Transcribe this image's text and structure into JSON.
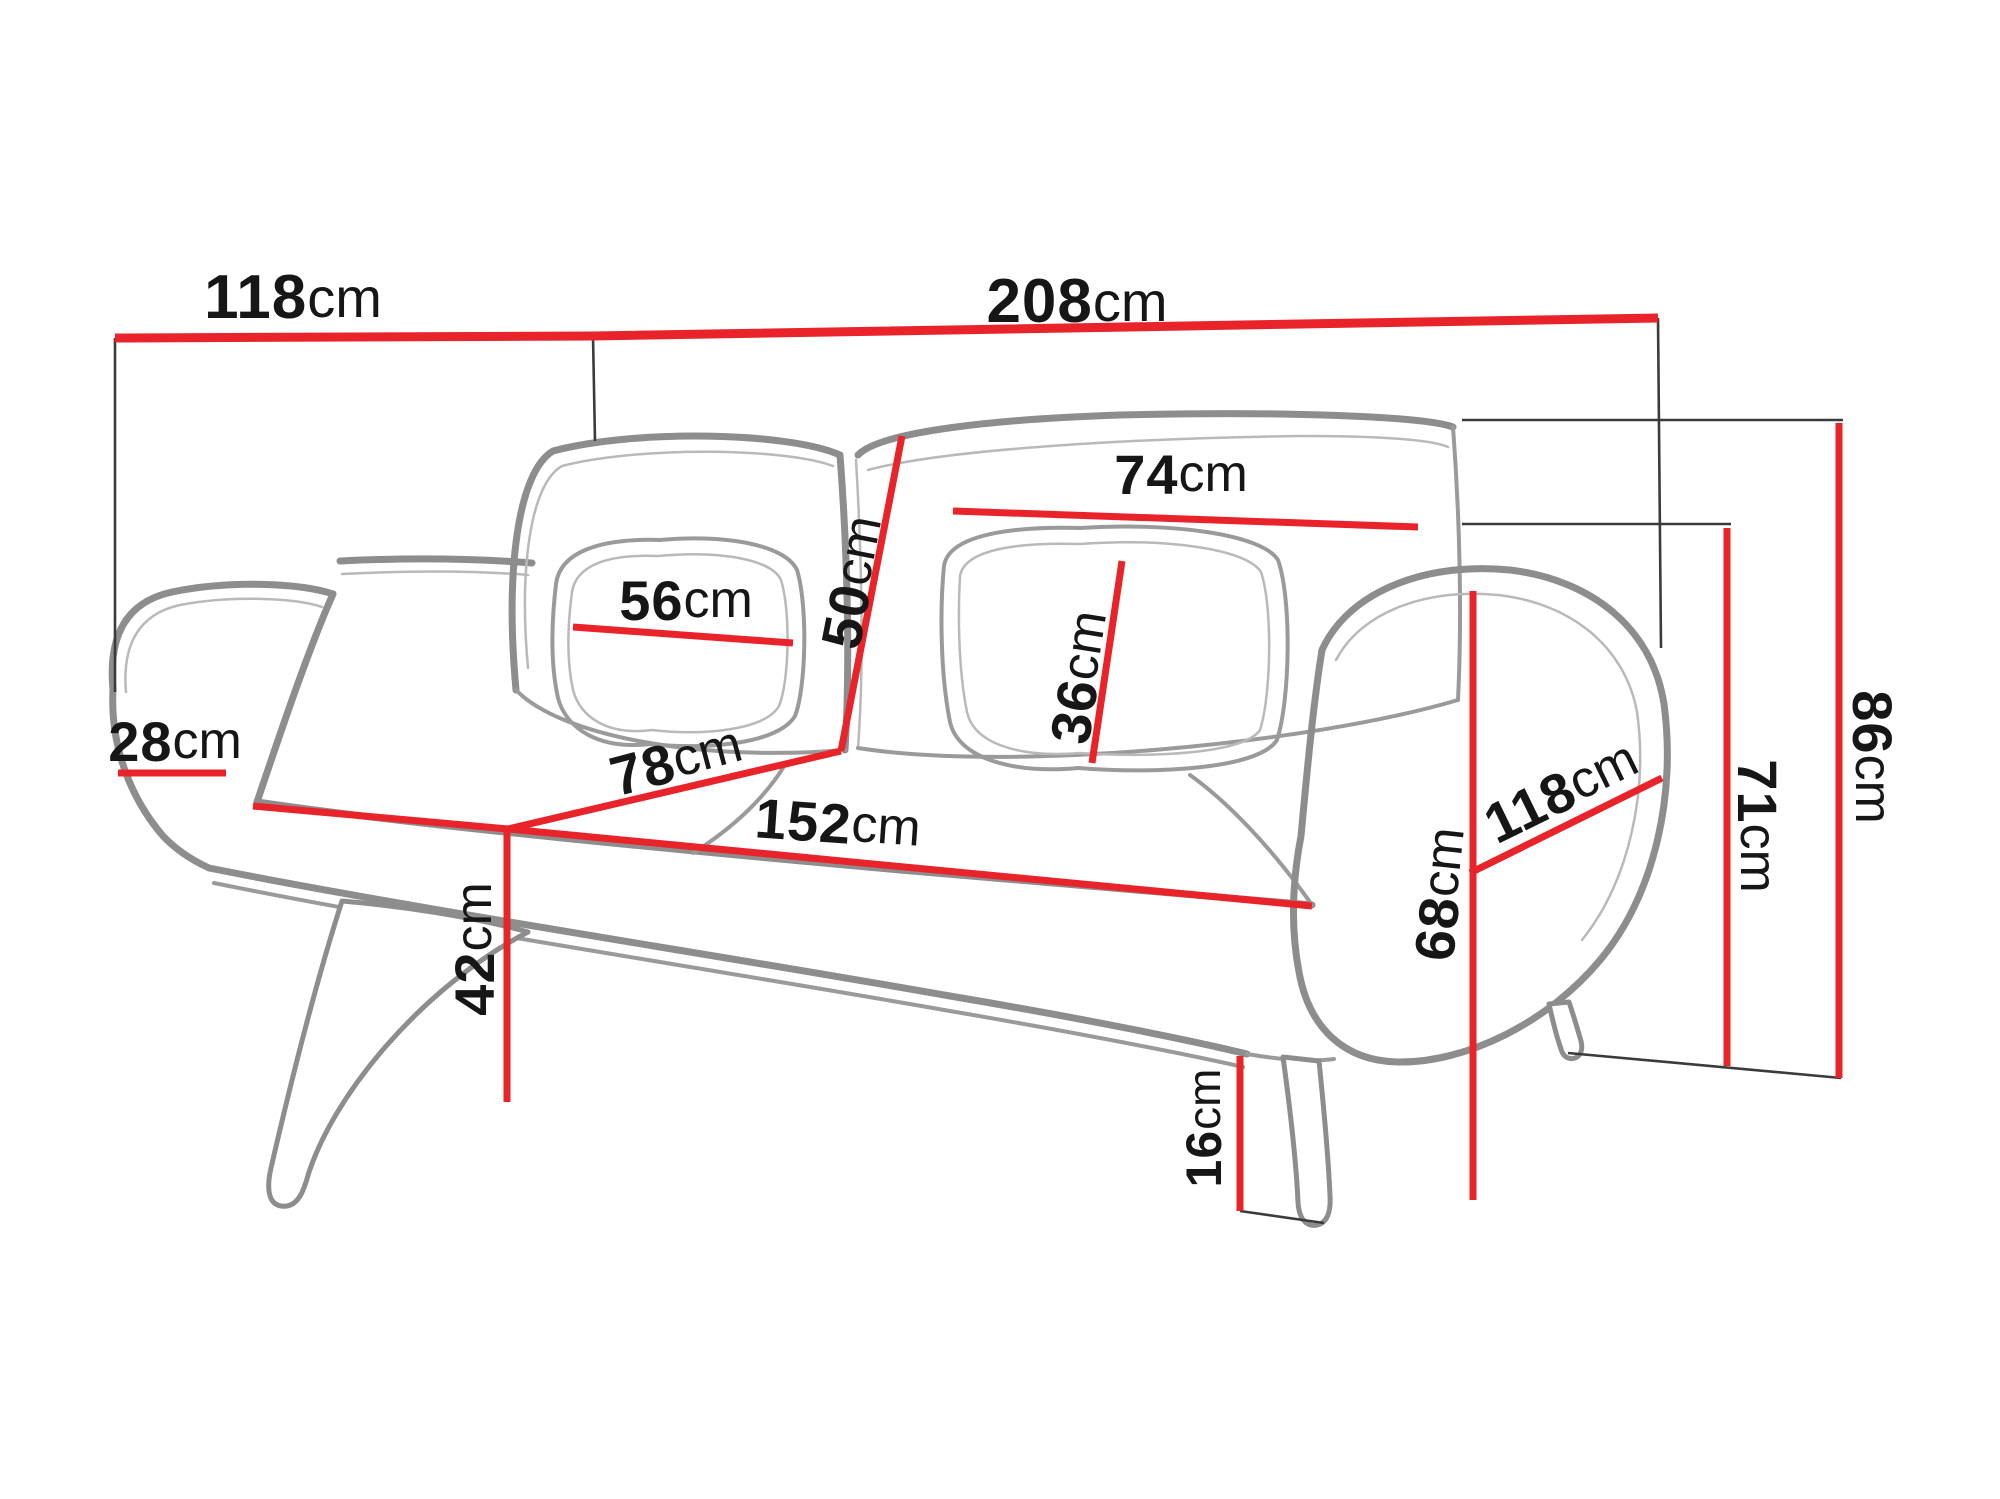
{
  "diagram": {
    "type": "sofa-dimension-drawing",
    "unit": "cm",
    "colors": {
      "dimension_line": "#e8242a",
      "extension_line": "#3b3b3b",
      "drawing_line": "#8d8d8d",
      "text": "#161616",
      "background": "#ffffff"
    },
    "dimensions": [
      {
        "id": "front-width",
        "num": "118",
        "unit": "cm",
        "value": 118
      },
      {
        "id": "total-width",
        "num": "208",
        "unit": "cm",
        "value": 208
      },
      {
        "id": "back-cushion-width",
        "num": "74",
        "unit": "cm",
        "value": 74
      },
      {
        "id": "pillow-width",
        "num": "56",
        "unit": "cm",
        "value": 56
      },
      {
        "id": "back-cushion-height",
        "num": "50",
        "unit": "cm",
        "value": 50
      },
      {
        "id": "pillow-height",
        "num": "36",
        "unit": "cm",
        "value": 36
      },
      {
        "id": "armrest-width",
        "num": "28",
        "unit": "cm",
        "value": 28
      },
      {
        "id": "seat-depth",
        "num": "78",
        "unit": "cm",
        "value": 78
      },
      {
        "id": "seat-width",
        "num": "152",
        "unit": "cm",
        "value": 152
      },
      {
        "id": "seat-height",
        "num": "42",
        "unit": "cm",
        "value": 42
      },
      {
        "id": "armrest-height",
        "num": "68",
        "unit": "cm",
        "value": 68
      },
      {
        "id": "side-depth",
        "num": "118",
        "unit": "cm",
        "value": 118
      },
      {
        "id": "leg-height",
        "num": "16",
        "unit": "cm",
        "value": 16
      },
      {
        "id": "back-height",
        "num": "71",
        "unit": "cm",
        "value": 71
      },
      {
        "id": "total-height",
        "num": "86",
        "unit": "cm",
        "value": 86
      }
    ]
  }
}
